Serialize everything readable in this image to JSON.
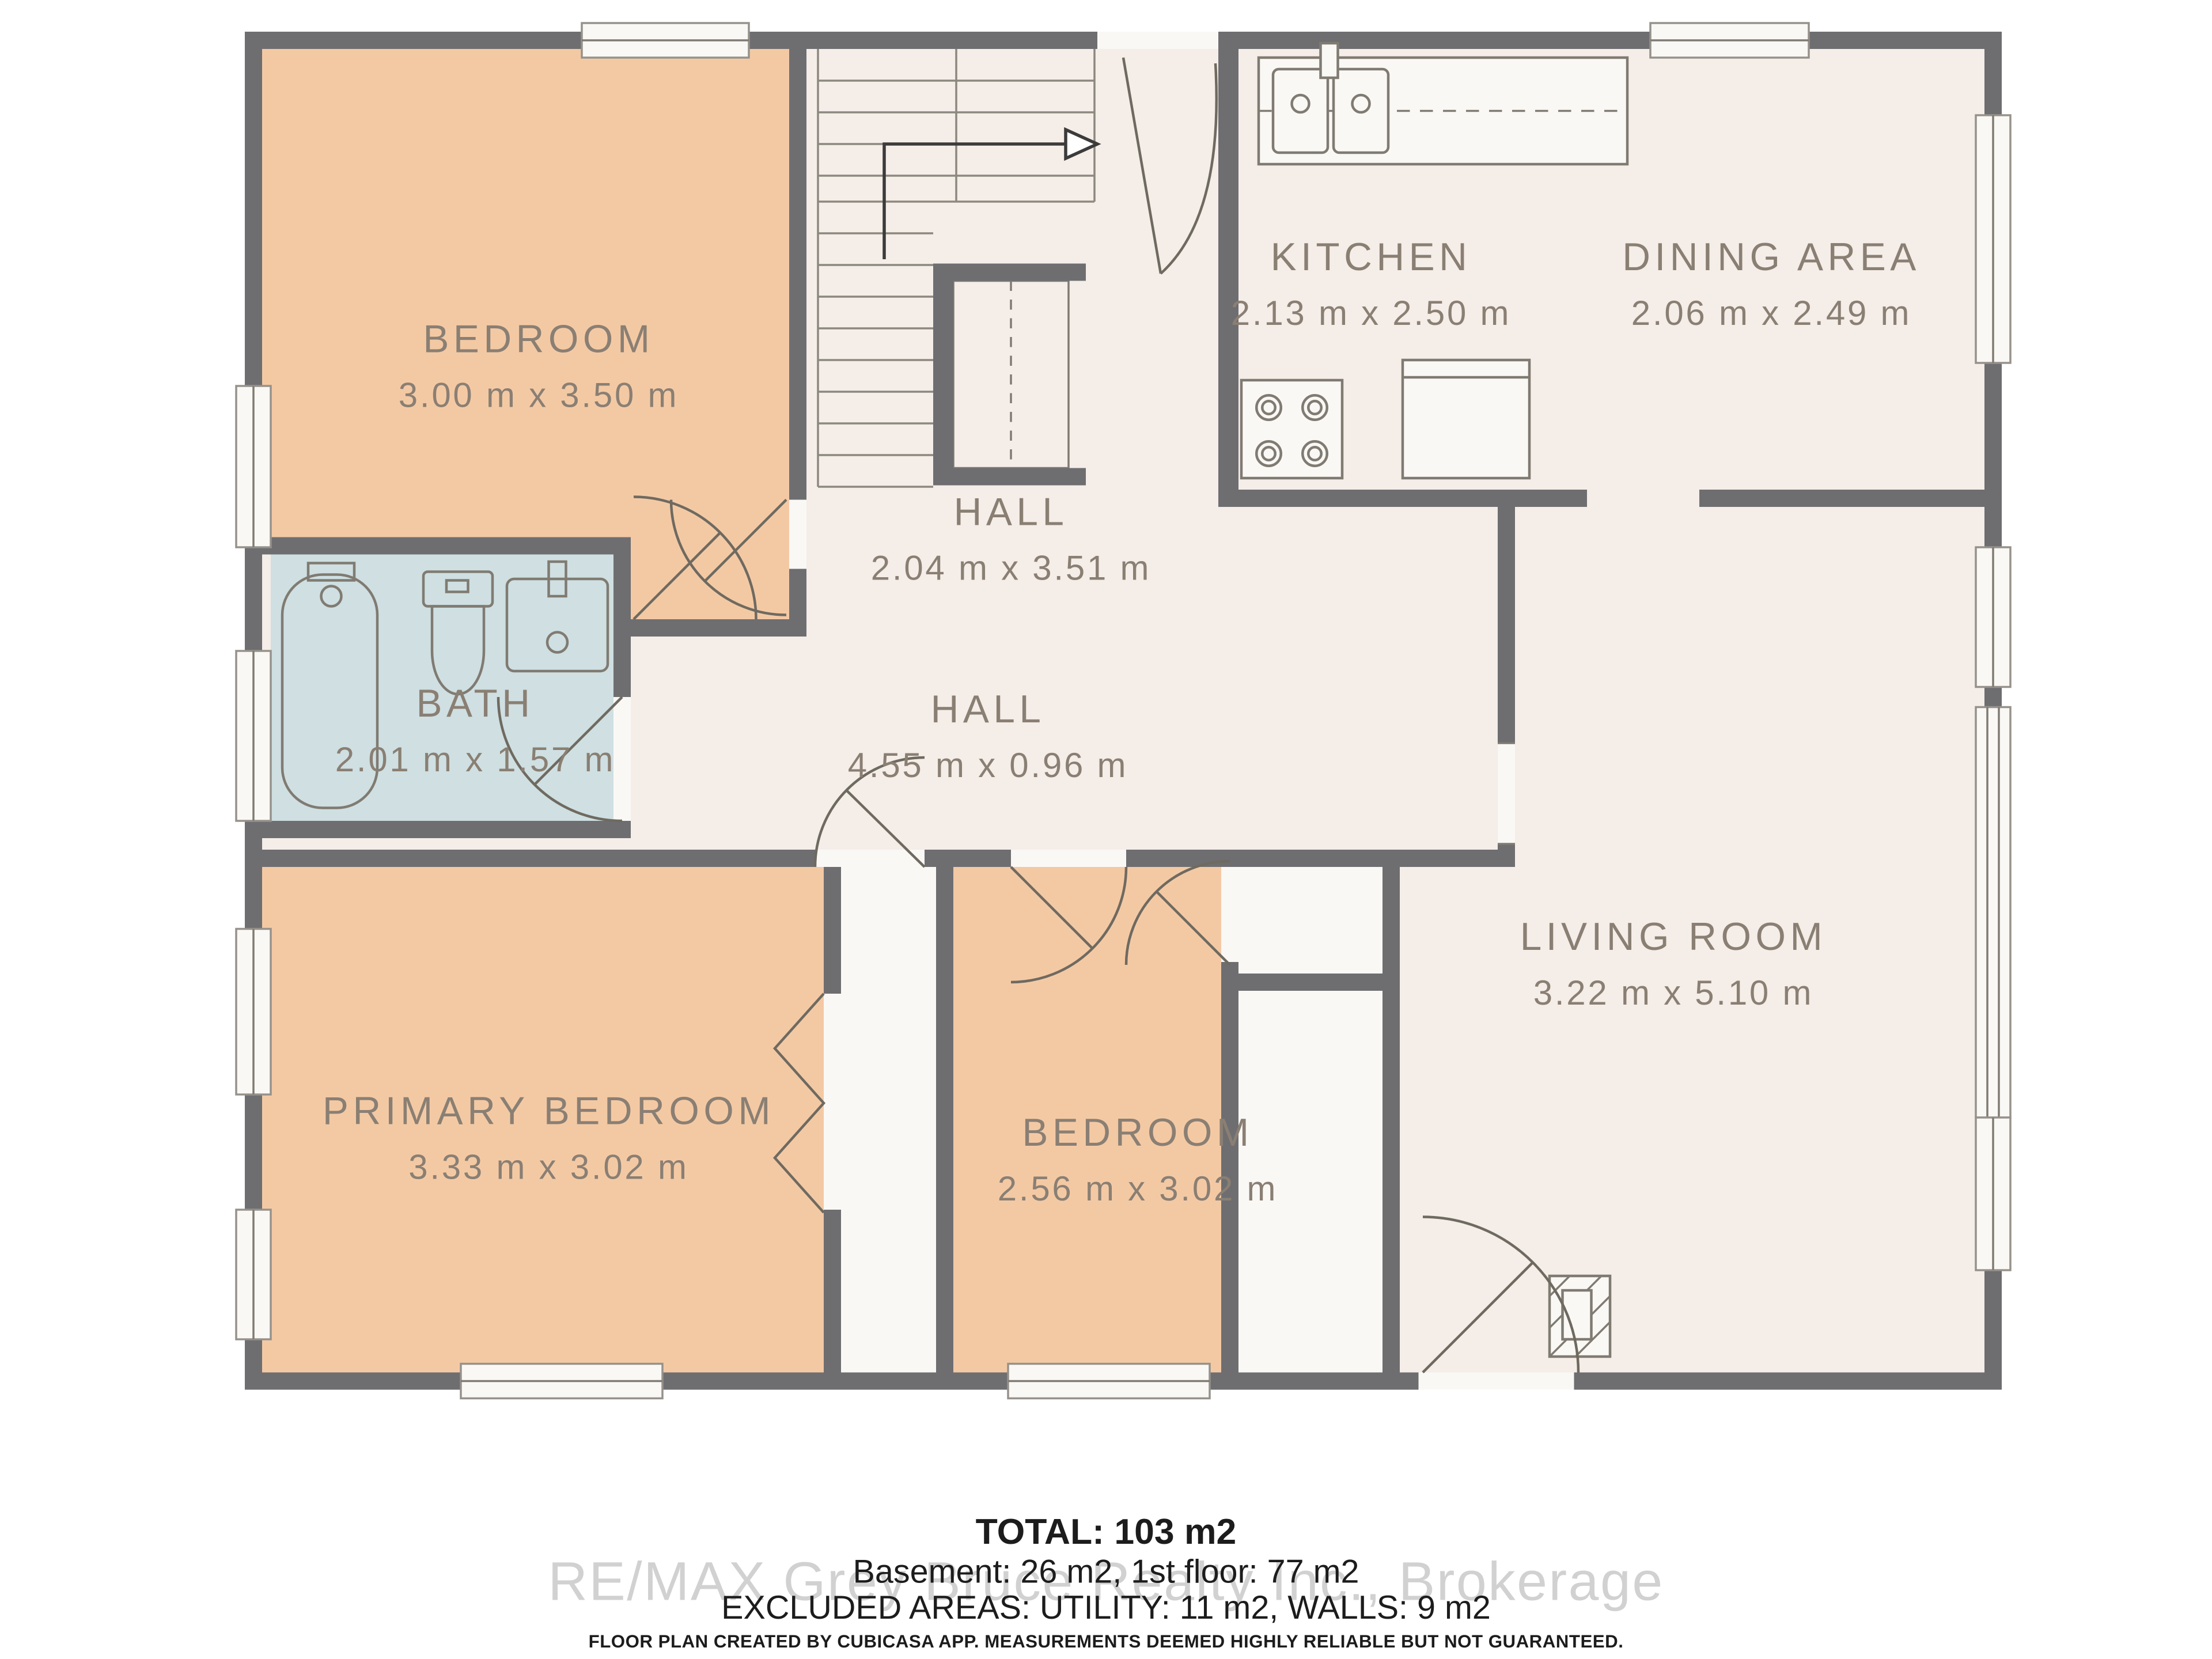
{
  "title": "Floor plan - 1st floor",
  "rooms": [
    {
      "id": "bedroom_tl",
      "name": "BEDROOM",
      "dims": "3.00 m x 3.50 m"
    },
    {
      "id": "kitchen",
      "name": "KITCHEN",
      "dims": "2.13 m x 2.50 m"
    },
    {
      "id": "dining",
      "name": "DINING AREA",
      "dims": "2.06 m x 2.49 m"
    },
    {
      "id": "hall_upper",
      "name": "HALL",
      "dims": "2.04 m x 3.51 m"
    },
    {
      "id": "bath",
      "name": "BATH",
      "dims": "2.01 m x 1.57 m"
    },
    {
      "id": "hall_lower",
      "name": "HALL",
      "dims": "4.55 m x 0.96 m"
    },
    {
      "id": "primary_bedroom",
      "name": "PRIMARY BEDROOM",
      "dims": "3.33 m x 3.02 m"
    },
    {
      "id": "bedroom_mid",
      "name": "BEDROOM",
      "dims": "2.56 m x 3.02 m"
    },
    {
      "id": "living_room",
      "name": "LIVING ROOM",
      "dims": "3.22 m x 5.10 m"
    }
  ],
  "summary": {
    "total": "TOTAL: 103 m2",
    "floors": "Basement: 26 m2, 1st floor: 77 m2",
    "excluded": "EXCLUDED AREAS: UTILITY: 11 m2, WALLS: 9 m2"
  },
  "watermark": "RE/MAX Grey Bruce Realty Inc., Brokerage",
  "disclaimer": "FLOOR PLAN CREATED BY CUBICASA APP. MEASUREMENTS DEEMED HIGHLY RELIABLE BUT NOT GUARANTEED.",
  "icons": [
    "stairs-icon",
    "stairs-direction-arrow-icon",
    "bathtub-icon",
    "toilet-icon",
    "bathroom-sink-icon",
    "kitchen-sink-icon",
    "stove-icon",
    "fridge-icon",
    "fireplace-icon",
    "door-arc-icon",
    "window-icon"
  ],
  "colors": {
    "wall": "#6e6e71",
    "floor": "#f4ede8",
    "room-warm": "#f3c9a4",
    "room-wet": "#cfdfe2",
    "fixture-white": "#faf8f5",
    "label-text": "#8a7f73",
    "watermark": "#c6c6c6"
  }
}
